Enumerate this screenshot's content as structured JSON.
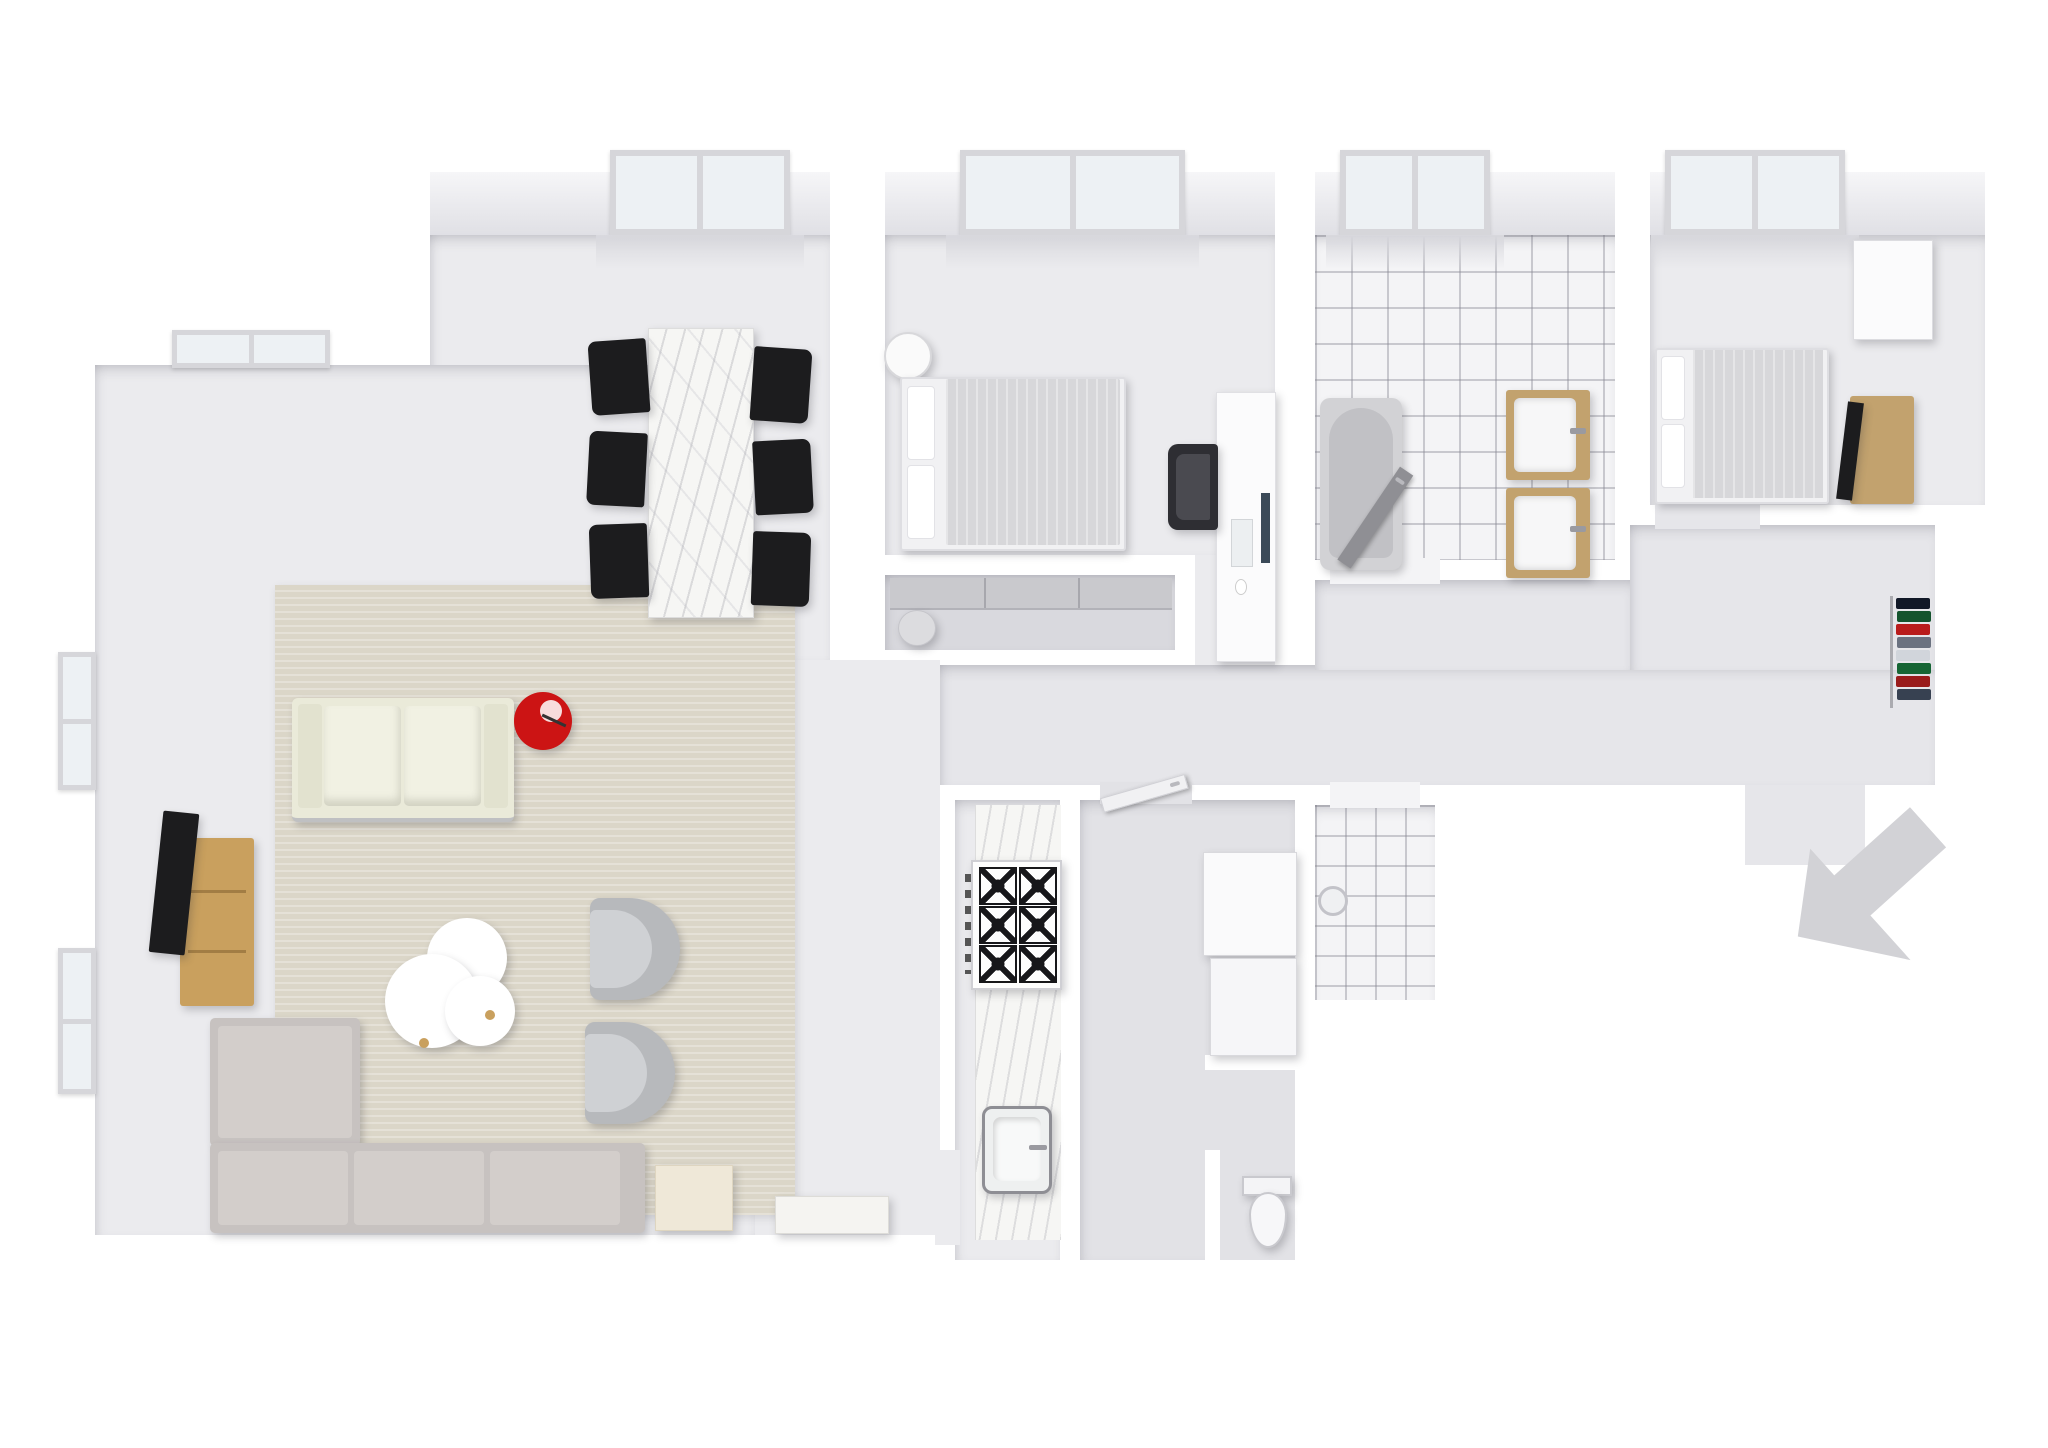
{
  "scene": {
    "kind": "3d-floor-plan-render",
    "view": "top-down isometric dollhouse view of an apartment",
    "walls": "white",
    "no_visible_text": true
  },
  "colors": {
    "wall": "#ffffff",
    "floor": "#ebebee",
    "floor_dark": "#e2e2e6",
    "corridor": "#e6e6ea",
    "closet_floor": "#d9d9de",
    "tile": "#f4f4f6",
    "rug": "#dbd6c8",
    "marble": "#f6f6f4",
    "wood": "#c9a05e",
    "wood_light": "#c2a26e",
    "red": "#cc1414",
    "black": "#1c1c1e",
    "sofa_cream": "#eaead9",
    "sofa_gray": "#c7c2c0",
    "chair_gray": "#b7b9bc",
    "glass": "#edf1f4",
    "door": "#8f8f94",
    "arrow": "#d2d2d6",
    "bed_linen": "#f1f1f3",
    "duvet": "#d7d7da"
  },
  "rooms": [
    {
      "name": "Living room",
      "furniture": [
        "cream two-seat sofa",
        "red floor lamp",
        "oak tv console",
        "flatscreen tv",
        "cloud-shaped coffee table",
        "gray tub armchair",
        "gray tub armchair",
        "gray corner sectional sofa",
        "cream sideboard",
        "white bench",
        "beige rug"
      ],
      "windows": 3
    },
    {
      "name": "Dining area",
      "furniture": [
        "marble dining table",
        "six black chairs"
      ],
      "windows": 1
    },
    {
      "name": "Bedroom 1",
      "furniture": [
        "double bed",
        "round nightstand",
        "desk",
        "office chair",
        "monitor",
        "keyboard",
        "mouse"
      ],
      "windows": 1
    },
    {
      "name": "Walk-in closet",
      "furniture": [
        "sliding wardrobe",
        "stool"
      ],
      "windows": 0
    },
    {
      "name": "Bathroom",
      "furniture": [
        "bathtub",
        "vanity sink",
        "vanity sink",
        "open door"
      ],
      "windows": 1,
      "floor": "white tile"
    },
    {
      "name": "Bedroom 2",
      "furniture": [
        "double bed",
        "white wardrobe",
        "tv stand",
        "flatscreen tv"
      ],
      "windows": 1
    },
    {
      "name": "Kitchen",
      "furniture": [
        "marble counter",
        "gas stove with six burners",
        "built-in sink"
      ],
      "windows": 0
    },
    {
      "name": "Storage room",
      "furniture": [
        "white cabinet",
        "white cabinet",
        "door"
      ],
      "windows": 0
    },
    {
      "name": "WC",
      "furniture": [
        "toilet"
      ],
      "windows": 0
    },
    {
      "name": "Utility room",
      "furniture": [
        "floor drain"
      ],
      "windows": 0,
      "floor": "white tile"
    },
    {
      "name": "Hallway",
      "furniture": [
        "coat rack with colorful clothes"
      ],
      "windows": 0
    }
  ],
  "entrance": {
    "marker": "gray arrow",
    "direction": "pointing up-left into the entrance opening"
  },
  "coat_rack_colors": [
    "#111827",
    "#14532d",
    "#b91c1c",
    "#6b7280",
    "#d1d5db",
    "#166534",
    "#991b1b",
    "#374151"
  ]
}
